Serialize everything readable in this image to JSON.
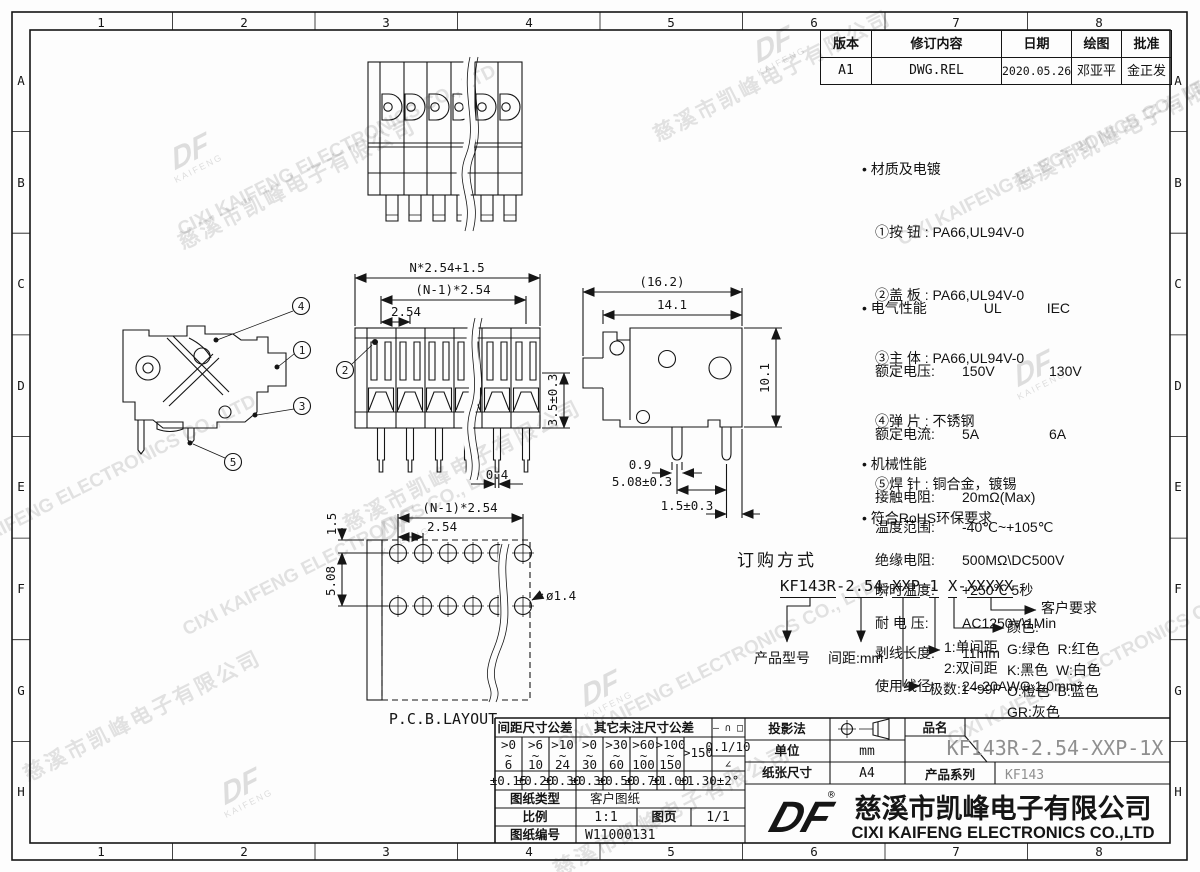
{
  "frame": {
    "cols": [
      "1",
      "2",
      "3",
      "4",
      "5",
      "6",
      "7",
      "8"
    ],
    "rows": [
      "A",
      "B",
      "C",
      "D",
      "E",
      "F",
      "G",
      "H"
    ]
  },
  "revision": {
    "headers": [
      "版本",
      "修订内容",
      "日期",
      "绘图",
      "批准"
    ],
    "row": [
      "A1",
      "DWG.REL",
      "2020.05.26",
      "邓亚平",
      "金正发"
    ]
  },
  "specs": {
    "material": {
      "title": "• 材质及电镀",
      "lines": [
        "①按 钮 : PA66,UL94V-0",
        "②盖 板 : PA66,UL94V-0",
        "③主 体 : PA66,UL94V-0",
        "④弹 片 : 不锈钢",
        "⑤焊 针 : 铜合金，镀锡"
      ]
    },
    "electrical": {
      "title": "• 电气性能",
      "col1": "UL",
      "col2": "IEC",
      "rows": [
        [
          "额定电压:",
          "150V",
          "130V"
        ],
        [
          "额定电流:",
          "5A",
          "6A"
        ],
        [
          "接触电阻:",
          "20mΩ(Max)",
          ""
        ],
        [
          "绝缘电阻:",
          "500MΩ\\DC500V",
          ""
        ],
        [
          "耐 电 压:",
          "AC1250V\\1Min",
          ""
        ],
        [
          "使用线径:",
          "24-20AWG 1.0mm²",
          ""
        ]
      ]
    },
    "mechanical": {
      "title": "• 机械性能",
      "rows": [
        [
          "温度范围:",
          "-40℃~+105℃"
        ],
        [
          "瞬时温度:",
          "+250℃ 5秒"
        ],
        [
          "剥线长度:",
          "11mm"
        ]
      ]
    },
    "rohs": "• 符合RoHS环保要求"
  },
  "dims": {
    "callouts": [
      "1",
      "2",
      "3",
      "4",
      "5"
    ],
    "front": {
      "overall": "N*2.54+1.5",
      "span": "(N-1)*2.54",
      "pitch": "2.54",
      "pin_len": "3.5±0.3",
      "pin_w": "0.4"
    },
    "side": {
      "overall": "(16.2)",
      "body": "14.1",
      "height": "10.1",
      "pin_d": "0.9",
      "pin_pitch": "5.08±0.3",
      "edge": "1.5±0.3"
    },
    "pcb": {
      "edge": "1.5",
      "row_pitch": "5.08",
      "span": "(N-1)*2.54",
      "pitch": "2.54",
      "hole": "ø1.4",
      "label": "P.C.B.LAYOUT"
    }
  },
  "ordering": {
    "title": "订购方式",
    "code": {
      "p1": "KF143R",
      "d1": "-",
      "p2": "2.54",
      "d2": "-",
      "p3": "XXP",
      "d3": "-",
      "p4": "1",
      "sp": " ",
      "p5": "X",
      "d4": "-",
      "p6": "XXXXX"
    },
    "labels": {
      "model": "产品型号",
      "pitch": "间距:mm",
      "poles": "极数:1~99P",
      "single": "1:单间距",
      "double": "2:双间距",
      "color_title": "颜色:",
      "colors": [
        "G:绿色  R:红色",
        "K:黑色  W:白色",
        "O:橙色  B:蓝色",
        "GR:灰色"
      ],
      "customer": "客户要求"
    }
  },
  "titleblock": {
    "tol": {
      "pitch_header": "间距尺寸公差",
      "other_header": "其它未注尺寸公差",
      "sym_row": "— ∩ □",
      "tilde": "~",
      "ranges_top": [
        ">0",
        ">6",
        ">10",
        ">0",
        ">30",
        ">60",
        ">100"
      ],
      "ranges_bot": [
        "6",
        "10",
        "24",
        "30",
        "60",
        "100",
        "150"
      ],
      "range_last": ">150",
      "tols": [
        "±0.15",
        "±0.20",
        "±0.30",
        "±0.30",
        "±0.50",
        "±0.70",
        "±1.00",
        "±1.30"
      ],
      "flatness": "0.1/10",
      "angle_sym": "∠",
      "angle_tol": "±2°"
    },
    "sheet_type_label": "图纸类型",
    "sheet_type": "客户图纸",
    "scale_label": "比例",
    "scale": "1:1",
    "page_label": "图页",
    "page": "1/1",
    "dwg_label": "图纸编号",
    "dwg_no": "W11000131",
    "projection_label": "投影法",
    "unit_label": "单位",
    "unit": "mm",
    "paper_label": "纸张尺寸",
    "paper": "A4",
    "part_label": "品名",
    "part_name": "KF143R-2.54-XXP-1X",
    "series_label": "产品系列",
    "series": "KF143",
    "logo": "DF",
    "reg": "®",
    "company_cn": "慈溪市凯峰电子有限公司",
    "company_en": "CIXI KAIFENG ELECTRONICS CO.,LTD"
  },
  "watermark": {
    "cn": "慈溪市凯峰电子有限公司",
    "en": "CIXI KAIFENG ELECTRONICS CO., LTD",
    "logo": "KAIFENG"
  }
}
